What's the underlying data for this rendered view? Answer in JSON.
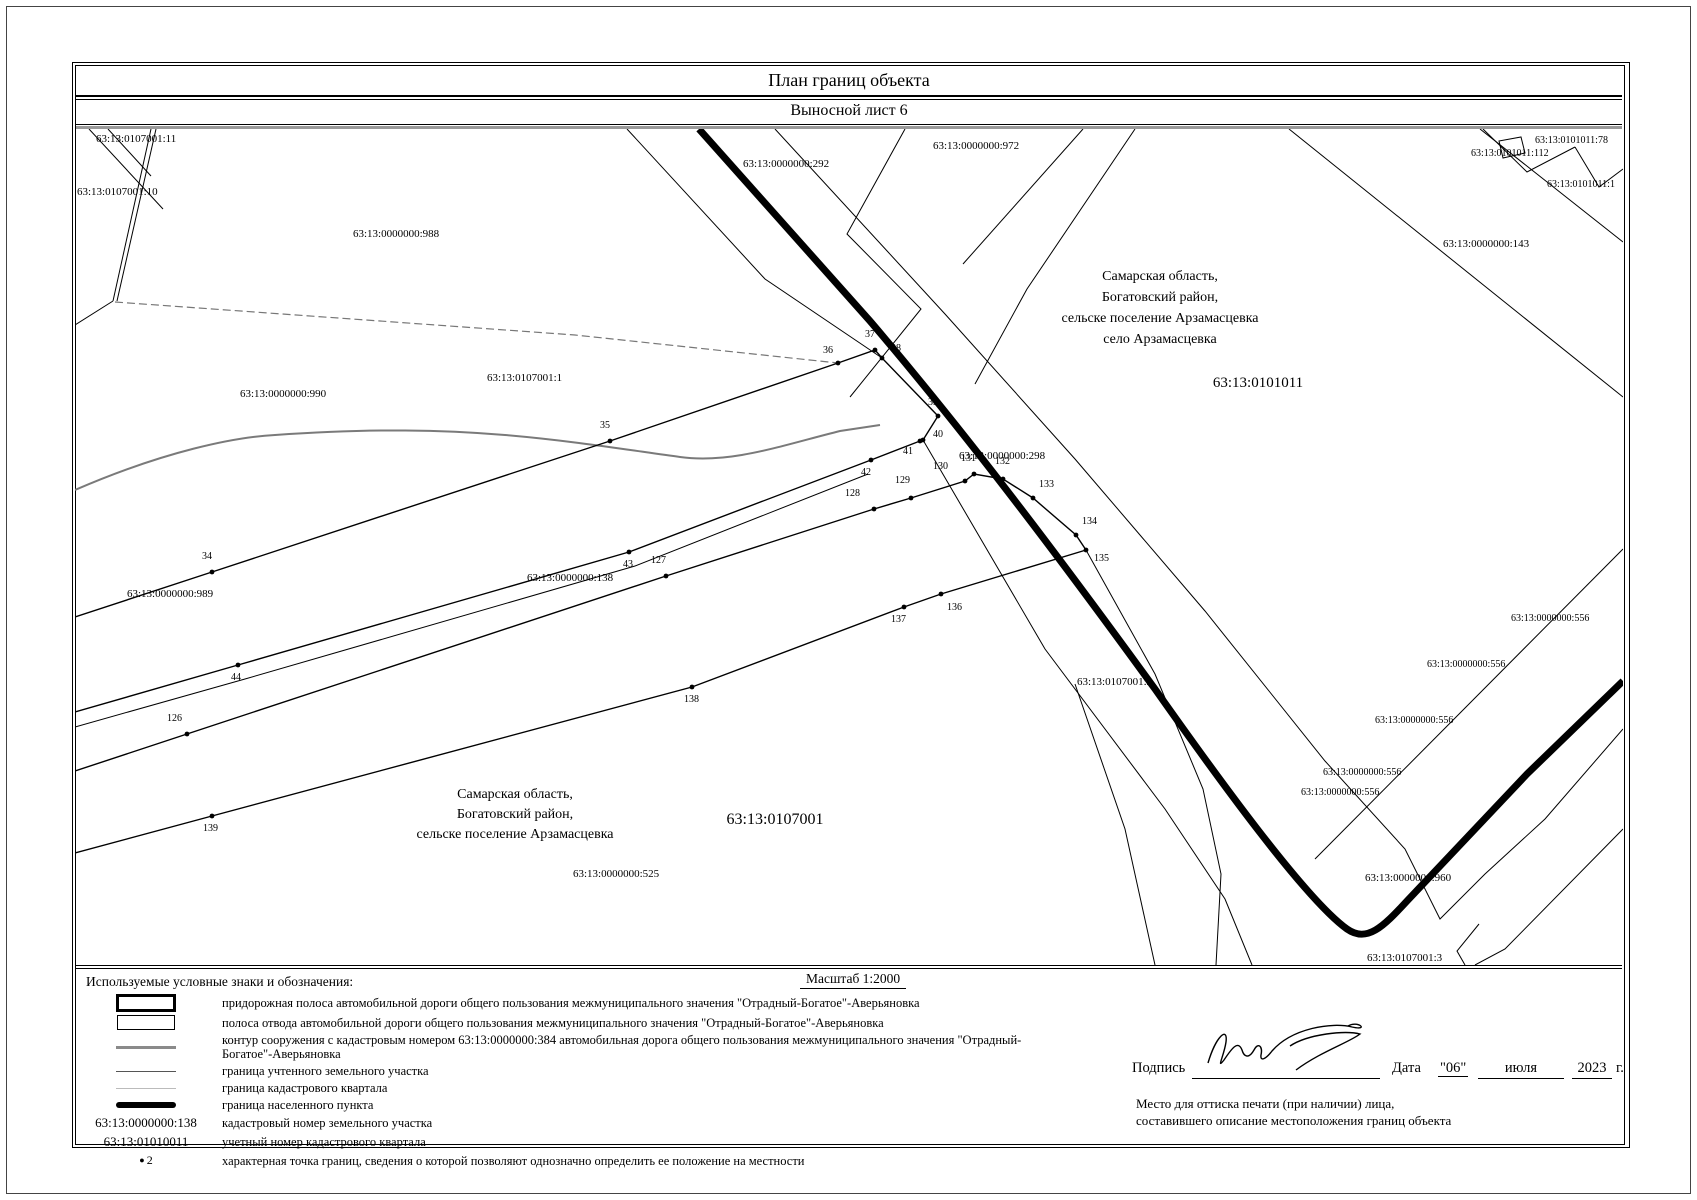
{
  "page": {
    "title1": "План границ объекта",
    "title2": "Выносной лист 6"
  },
  "map": {
    "labels": [
      {
        "t": "63:13:0107001:11",
        "x": 21,
        "y": 13,
        "fs": 11
      },
      {
        "t": "63:13:0107001:10",
        "x": 2,
        "y": 66,
        "fs": 11
      },
      {
        "t": "63:13:0000000:988",
        "x": 278,
        "y": 108,
        "fs": 11
      },
      {
        "t": "63:13:0000000:990",
        "x": 165,
        "y": 268,
        "fs": 11
      },
      {
        "t": "63:13:0107001:1",
        "x": 412,
        "y": 252,
        "fs": 11
      },
      {
        "t": "63:13:0000000:292",
        "x": 668,
        "y": 38,
        "fs": 11
      },
      {
        "t": "63:13:0000000:972",
        "x": 858,
        "y": 20,
        "fs": 11
      },
      {
        "t": "63:13:0101011:78",
        "x": 1460,
        "y": 14,
        "fs": 10
      },
      {
        "t": "63:13:0101011:112",
        "x": 1396,
        "y": 27,
        "fs": 10
      },
      {
        "t": "63:13:0101011:1",
        "x": 1472,
        "y": 58,
        "fs": 10
      },
      {
        "t": "63:13:0000000:143",
        "x": 1368,
        "y": 118,
        "fs": 11
      },
      {
        "t": "63:13:0000000:298",
        "x": 884,
        "y": 330,
        "fs": 11
      },
      {
        "t": "63:13:0000000:989",
        "x": 52,
        "y": 468,
        "fs": 11
      },
      {
        "t": "63:13:0000000:138",
        "x": 452,
        "y": 452,
        "fs": 11
      },
      {
        "t": "63:13:0107001:2",
        "x": 1002,
        "y": 556,
        "fs": 11
      },
      {
        "t": "63:13:0000000:556",
        "x": 1436,
        "y": 492,
        "fs": 10
      },
      {
        "t": "63:13:0000000:556",
        "x": 1352,
        "y": 538,
        "fs": 10
      },
      {
        "t": "63:13:0000000:556",
        "x": 1300,
        "y": 594,
        "fs": 10
      },
      {
        "t": "63:13:0000000:556",
        "x": 1248,
        "y": 646,
        "fs": 10
      },
      {
        "t": "63:13:0000000:556",
        "x": 1226,
        "y": 666,
        "fs": 10
      },
      {
        "t": "63:13:0000000:960",
        "x": 1290,
        "y": 752,
        "fs": 11
      },
      {
        "t": "63:13:0107001:3",
        "x": 1292,
        "y": 832,
        "fs": 11
      },
      {
        "t": "63:13:0000000:525",
        "x": 498,
        "y": 748,
        "fs": 11
      },
      {
        "t": "Самарская область,",
        "x": 1085,
        "y": 151,
        "fs": 14,
        "mid": 1
      },
      {
        "t": "Богатовский район,",
        "x": 1085,
        "y": 172,
        "fs": 14,
        "mid": 1
      },
      {
        "t": "сельске поселение Арзамасцевка",
        "x": 1085,
        "y": 193,
        "fs": 14,
        "mid": 1
      },
      {
        "t": "село Арзамасцевка",
        "x": 1085,
        "y": 214,
        "fs": 14,
        "mid": 1
      },
      {
        "t": "63:13:0101011",
        "x": 1183,
        "y": 258,
        "fs": 15,
        "mid": 1
      },
      {
        "t": "Самарская область,",
        "x": 440,
        "y": 669,
        "fs": 14,
        "mid": 1
      },
      {
        "t": "Богатовский район,",
        "x": 440,
        "y": 689,
        "fs": 14,
        "mid": 1
      },
      {
        "t": "сельске поселение Арзамасцевка",
        "x": 440,
        "y": 709,
        "fs": 14,
        "mid": 1
      },
      {
        "t": "63:13:0107001",
        "x": 700,
        "y": 695,
        "fs": 16,
        "mid": 1
      }
    ],
    "points": [
      {
        "n": "34",
        "x": 137,
        "y": 443,
        "lx": 127,
        "ly": 430
      },
      {
        "n": "35",
        "x": 535,
        "y": 312,
        "lx": 525,
        "ly": 299
      },
      {
        "n": "36",
        "x": 763,
        "y": 234,
        "lx": 748,
        "ly": 224
      },
      {
        "n": "37",
        "x": 800,
        "y": 221,
        "lx": 790,
        "ly": 208
      },
      {
        "n": "38",
        "x": 807,
        "y": 229,
        "lx": 816,
        "ly": 222
      },
      {
        "n": "39",
        "x": 863,
        "y": 287,
        "lx": 853,
        "ly": 276
      },
      {
        "n": "40",
        "x": 848,
        "y": 311,
        "lx": 858,
        "ly": 308
      },
      {
        "n": "41",
        "x": 845,
        "y": 312,
        "lx": 828,
        "ly": 325
      },
      {
        "n": "42",
        "x": 796,
        "y": 331,
        "lx": 786,
        "ly": 346
      },
      {
        "n": "43",
        "x": 554,
        "y": 423,
        "lx": 548,
        "ly": 438
      },
      {
        "n": "44",
        "x": 163,
        "y": 536,
        "lx": 156,
        "ly": 551
      },
      {
        "n": "126",
        "x": 112,
        "y": 605,
        "lx": 92,
        "ly": 592
      },
      {
        "n": "127",
        "x": 591,
        "y": 447,
        "lx": 576,
        "ly": 434
      },
      {
        "n": "128",
        "x": 799,
        "y": 380,
        "lx": 770,
        "ly": 367
      },
      {
        "n": "129",
        "x": 836,
        "y": 369,
        "lx": 820,
        "ly": 354
      },
      {
        "n": "130",
        "x": 890,
        "y": 352,
        "lx": 858,
        "ly": 340
      },
      {
        "n": "131",
        "x": 899,
        "y": 345,
        "lx": 886,
        "ly": 332
      },
      {
        "n": "132",
        "x": 928,
        "y": 350,
        "lx": 920,
        "ly": 335
      },
      {
        "n": "133",
        "x": 958,
        "y": 369,
        "lx": 964,
        "ly": 358
      },
      {
        "n": "134",
        "x": 1001,
        "y": 406,
        "lx": 1007,
        "ly": 395
      },
      {
        "n": "135",
        "x": 1011,
        "y": 421,
        "lx": 1019,
        "ly": 432
      },
      {
        "n": "136",
        "x": 866,
        "y": 465,
        "lx": 872,
        "ly": 481
      },
      {
        "n": "137",
        "x": 829,
        "y": 478,
        "lx": 816,
        "ly": 493
      },
      {
        "n": "138",
        "x": 617,
        "y": 558,
        "lx": 609,
        "ly": 573
      },
      {
        "n": "139",
        "x": 137,
        "y": 687,
        "lx": 128,
        "ly": 702
      }
    ],
    "lines": [
      {
        "d": "M76,0 L38,172",
        "cls": "ln"
      },
      {
        "d": "M81,0 L42,172",
        "cls": "ln"
      },
      {
        "d": "M14,0 L88,80",
        "cls": "ln"
      },
      {
        "d": "M33,0 L76,47",
        "cls": "ln"
      },
      {
        "d": "M38,172 L0,196",
        "cls": "ln"
      },
      {
        "d": "M40,173 L500,206 L763,234",
        "cls": "lngr"
      },
      {
        "d": "M0,361 C90,322 160,308 200,306 C300,299 370,301 430,306 C500,312 560,322 605,328 C655,335 705,317 765,302 L805,296",
        "cls": "lngr2"
      },
      {
        "d": "M0,488 L137,443 L535,312 L763,234",
        "cls": "lnb"
      },
      {
        "d": "M763,234 L800,221 L807,229 L863,287 L848,311 L845,312 L796,331 L554,423 L163,536 L0,583",
        "cls": "lnb"
      },
      {
        "d": "M0,642 L112,605 L591,447 L799,380 L836,369 L890,352 L899,345 L928,350 L958,369 L1001,406 L1011,421",
        "cls": "lnb"
      },
      {
        "d": "M1011,421 L866,465 L829,478 L617,558 L137,687 L0,724",
        "cls": "lnb"
      },
      {
        "d": "M0,598 L170,550 L560,437 L793,345",
        "cls": "ln"
      },
      {
        "d": "M848,311 L970,520 L1090,680 L1150,770 L1177,836",
        "cls": "ln"
      },
      {
        "d": "M1011,421 L1080,545 L1128,660 L1146,745 L1141,836",
        "cls": "ln"
      },
      {
        "d": "M552,0 L690,150 L807,229",
        "cls": "ln"
      },
      {
        "d": "M700,0 L870,185 L1000,330 L1130,482 L1250,632 L1330,720 L1365,790 L1410,745 L1470,690 L1548,600",
        "cls": "ln"
      },
      {
        "d": "M1240,730 L1548,420",
        "cls": "ln"
      },
      {
        "d": "M1214,0 L1548,268",
        "cls": "ln"
      },
      {
        "d": "M1405,0 L1548,113",
        "cls": "ln"
      },
      {
        "d": "M1408,0 L1452,43 L1500,18",
        "cls": "ln"
      },
      {
        "d": "M1500,18 L1524,58 L1548,40",
        "cls": "ln"
      },
      {
        "d": "M1424,12 L1446,8 L1450,24 L1428,29 Z",
        "cls": "ln"
      },
      {
        "d": "M830,0 L772,105 L846,180 L775,268",
        "cls": "ln"
      },
      {
        "d": "M1008,0 L888,135",
        "cls": "ln"
      },
      {
        "d": "M1060,0 L952,160 L900,255",
        "cls": "ln"
      },
      {
        "d": "M1548,700 L1430,820 L1400,836",
        "cls": "ln"
      },
      {
        "d": "M1404,795 L1382,822 L1390,836",
        "cls": "ln"
      },
      {
        "d": "M1000,555 L1050,700 L1080,836",
        "cls": "ln"
      },
      {
        "d": "M624,0 L795,192 C900,315 1000,450 1080,560 C1140,645 1230,770 1272,800 C1292,814 1308,798 1332,772 L1452,645 L1548,552",
        "cls": "lntk"
      }
    ]
  },
  "legend": {
    "title": "Используемые условные знаки и обозначения:",
    "scale": "Масштаб 1:2000",
    "rows": [
      {
        "sym": "rect-thick",
        "text": "придорожная полоса автомобильной дороги общего пользования межмуниципального значения \"Отрадный-Богатое\"-Аверьяновка"
      },
      {
        "sym": "rect-thin",
        "text": "полоса отвода автомобильной дороги общего пользования межмуниципального значения \"Отрадный-Богатое\"-Аверьяновка"
      },
      {
        "sym": "line-gray",
        "text": "контур сооружения с кадастровым номером 63:13:0000000:384 автомобильная дорога общего пользования межмуниципального значения \"Отрадный-Богатое\"-Аверьяновка"
      },
      {
        "sym": "line-thin",
        "text": "граница учтенного земельного участка"
      },
      {
        "sym": "line-faint",
        "text": "граница кадастрового квартала"
      },
      {
        "sym": "line-thick",
        "text": "граница населенного пункта"
      },
      {
        "sym": "text",
        "symtext": "63:13:0000000:138",
        "text": "кадастровый номер земельного участка"
      },
      {
        "sym": "text",
        "symtext": "63:13:01010011",
        "text": "учетный номер кадастрового квартала"
      },
      {
        "sym": "point",
        "symtext": "2",
        "text": "характерная точка границ, сведения о которой позволяют однозначно определить ее положение на местности"
      }
    ]
  },
  "footer": {
    "podpis_label": "Подпись",
    "data_label": "Дата",
    "day": "\"06\"",
    "month": "июля",
    "year": "2023",
    "g": "г.",
    "stamp_line1": "Место для оттиска печати (при наличии) лица,",
    "stamp_line2": "составившего описание местоположения границ объекта"
  }
}
